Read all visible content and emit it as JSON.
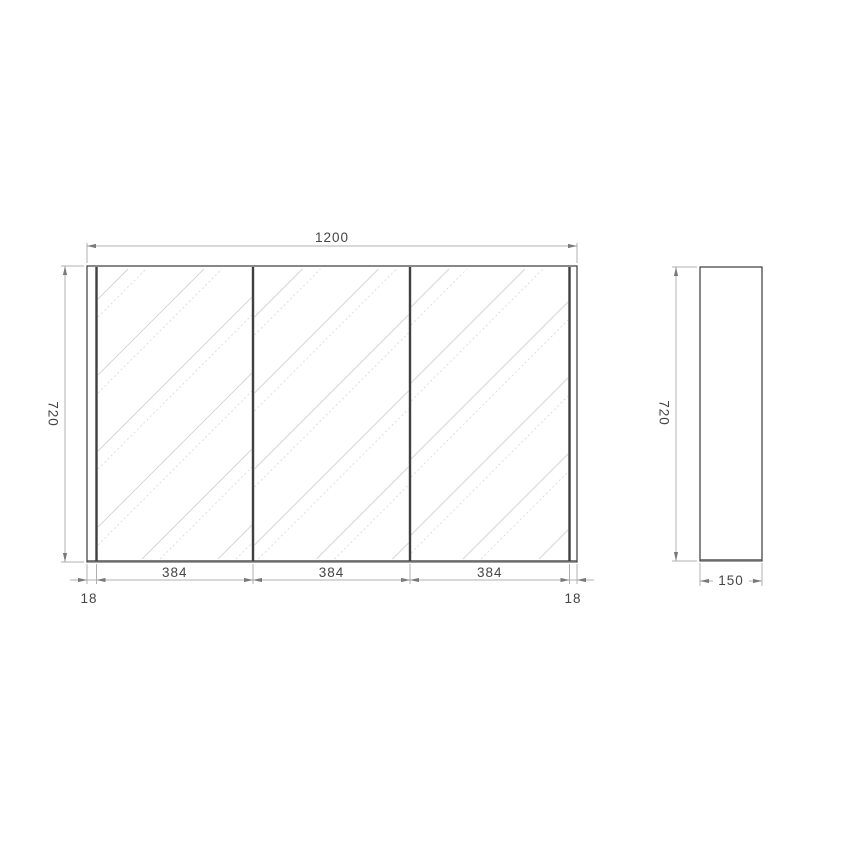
{
  "front_view": {
    "width_label": "1200",
    "height_label": "720",
    "door_labels": [
      "384",
      "384",
      "384"
    ],
    "edge_labels": [
      "18",
      "18"
    ]
  },
  "side_view": {
    "height_label": "720",
    "depth_label": "150"
  },
  "colors": {
    "object_line": "#3a3a3a",
    "dimension_line": "#b0b0b0",
    "hatch_line": "#d6d6d6",
    "text": "#454545",
    "background": "#ffffff"
  }
}
